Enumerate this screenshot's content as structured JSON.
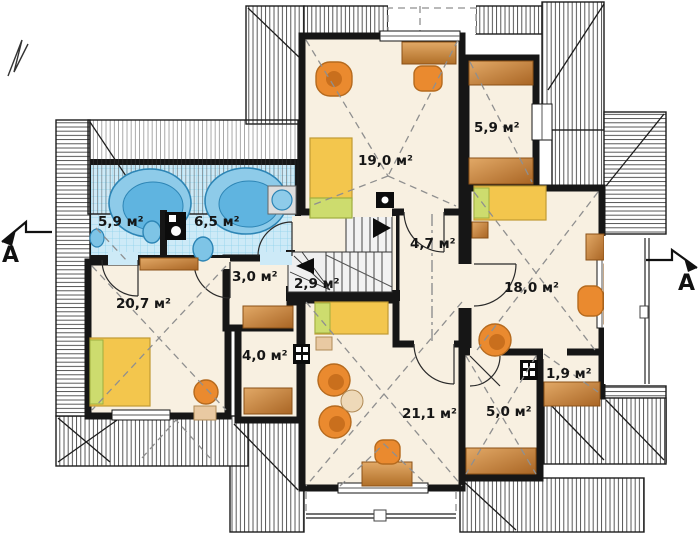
{
  "drawing": {
    "type": "floor-plan",
    "view": "attic-storey-plan",
    "unit_suffix": "м²"
  },
  "rooms": [
    {
      "id": "bathroom-small",
      "area": "5,9 м²"
    },
    {
      "id": "bathroom-large",
      "area": "6,5 м²"
    },
    {
      "id": "wardrobe-top",
      "area": "5,9 м²"
    },
    {
      "id": "bedroom-top",
      "area": "19,0 м²"
    },
    {
      "id": "hallway",
      "area": "4,7 м²"
    },
    {
      "id": "corridor",
      "area": "3,0 м²"
    },
    {
      "id": "staircase",
      "area": "2,9 м²"
    },
    {
      "id": "bedroom-left",
      "area": "20,7 м²"
    },
    {
      "id": "bedroom-right",
      "area": "18,0 м²"
    },
    {
      "id": "closet-left",
      "area": "4,0 м²"
    },
    {
      "id": "storage-small",
      "area": "1,9 м²"
    },
    {
      "id": "living-room",
      "area": "21,1 м²"
    },
    {
      "id": "room-bottom",
      "area": "5,0 м²"
    }
  ],
  "section_markers": {
    "left": "A",
    "right": "A"
  },
  "colors": {
    "floor": "#f8f0e1",
    "wall": "#161616",
    "roof_hatch": "#3f3f3f",
    "tile": "#cdeaf7",
    "tile_grid": "#8fd2ec",
    "water_blue": "#8ecbe9",
    "bed_yellow": "#f3c64d",
    "pillow_green": "#cddc6e",
    "furniture_orange": "#ea8a2f",
    "wood_brown": "#c98441",
    "dash_gray": "#8f8f8f"
  }
}
